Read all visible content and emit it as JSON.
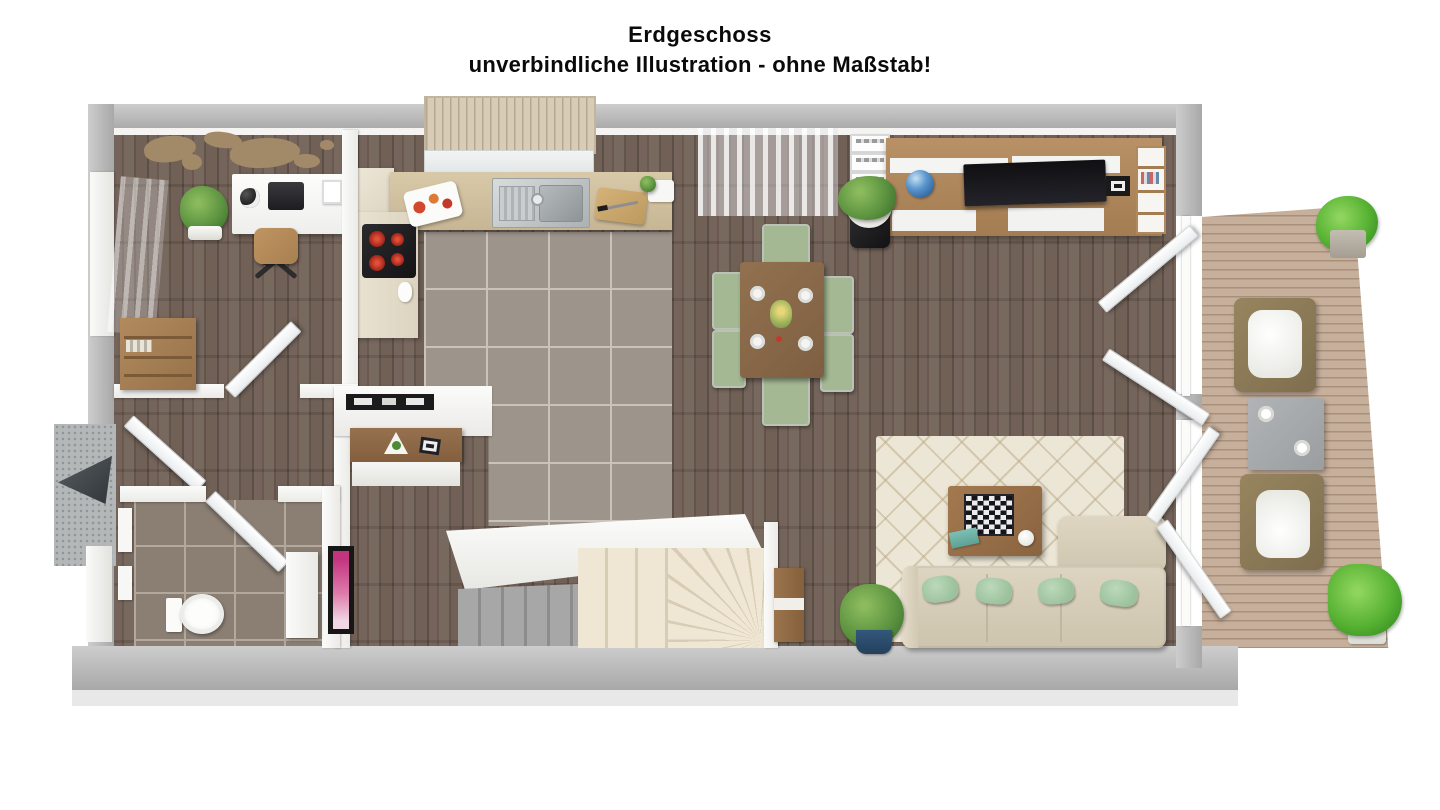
{
  "title": {
    "line1": "Erdgeschoss",
    "line2": "unverbindliche Illustration - ohne Maßstab!"
  },
  "colors": {
    "wood_floor": "#6d5d54",
    "kitchen_tile": "#9d958b",
    "bathroom_tile": "#8b7f74",
    "terrace_deck": "#c6af9b",
    "outer_wall": "#b0b0b0",
    "inner_wall": "#f3f2ef",
    "sofa_beige": "#d9d1bd",
    "pillow_mint": "#a9cda9",
    "dining_chair_green": "#a3b893",
    "dining_table_wood": "#8a6a4c",
    "tv_unit_wood": "#b1895f",
    "rug_cream": "#ece6d6",
    "stove_burner_red": "#c23222",
    "bath_art_magenta": "#c2347e",
    "plant_pot_blue": "#2e5275"
  }
}
